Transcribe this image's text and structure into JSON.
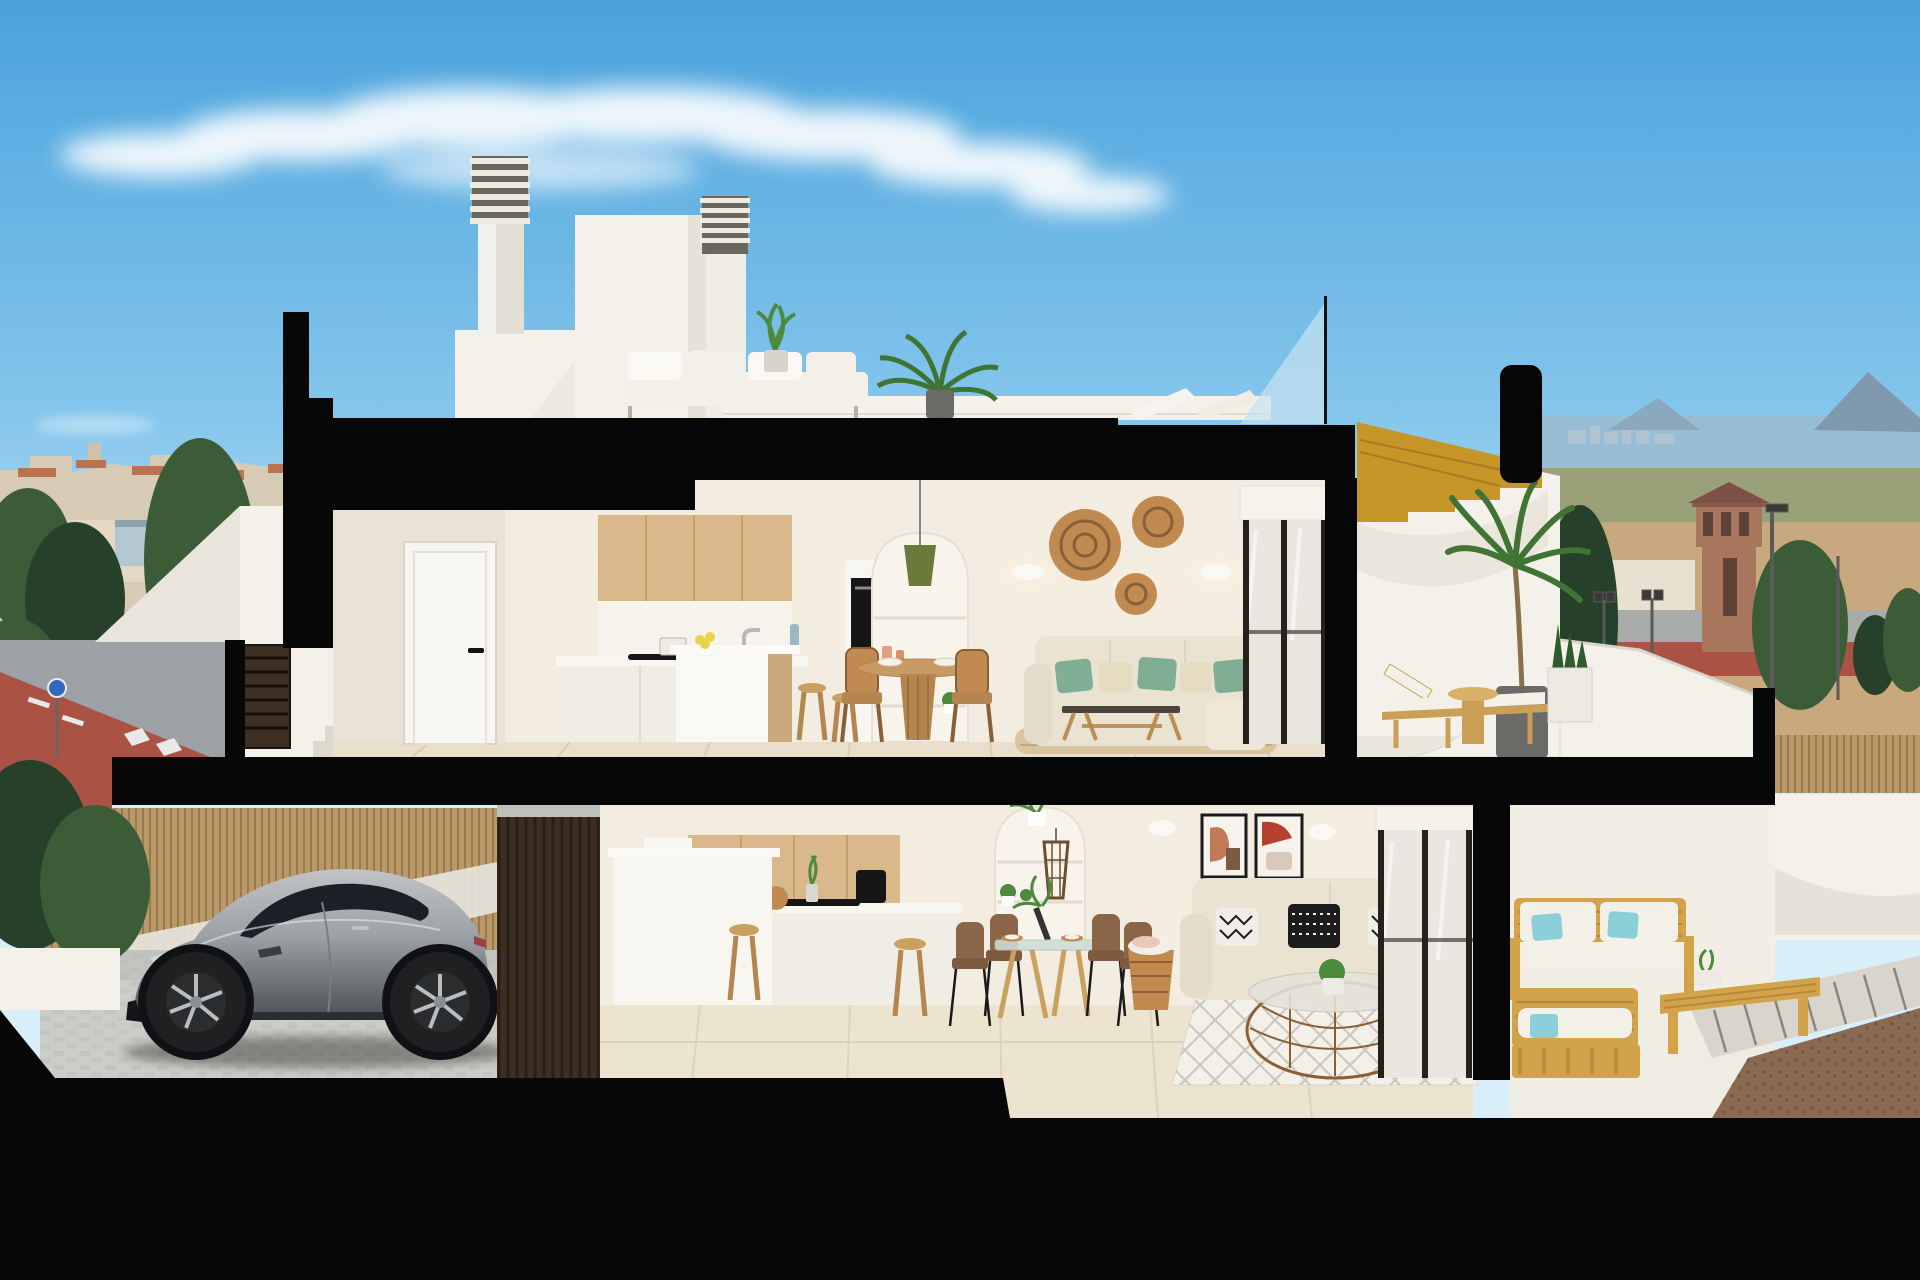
{
  "scene": {
    "kind": "architectural cross-section render",
    "subject": "two-storey coastal duplex cut-away with rooftop terrace, garage and furnished interiors",
    "elements": [
      "sky",
      "cloud-streak",
      "town-skyline-left",
      "sea-horizon-right",
      "watchtower",
      "cypress-trees",
      "street-with-bike-lane",
      "entrance-stairs",
      "louvered-gate",
      "section-cut-frame",
      "rooftop-terrace",
      "chimney",
      "stair-bulkhead",
      "rooftop-sofa",
      "rooftop-palm",
      "lounge-chairs",
      "upper-kitchen",
      "upper-hall-door",
      "kitchen-island",
      "dining-set",
      "arched-niche",
      "living-sofa",
      "coffee-table",
      "wicker-wall-discs",
      "wall-sconces",
      "sliding-glass-door",
      "wood-staircase",
      "upper-terrace-lounger",
      "terrace-palm",
      "garage",
      "sports-car",
      "bamboo-fence",
      "slat-feature-wall",
      "lower-kitchen",
      "lower-dining-set",
      "lower-sofa",
      "rattan-coffee-table",
      "diamond-rug",
      "framed-artworks",
      "lower-terrace-wood-sofas",
      "outdoor-bench-table",
      "walkway",
      "gravel-bed"
    ]
  },
  "palette": {
    "sky_top": "#4AA2DC",
    "sky_mid": "#85C6EC",
    "sky_horizon": "#D8EEF8",
    "cloud": "#FFFFFF",
    "sea": "#97BED4",
    "skyline": "#AFC4D2",
    "mountain": "#8199AE",
    "town_wall": "#D7CBB6",
    "town_roof": "#BA7350",
    "town_blue": "#B3C7D1",
    "tree_dark": "#26402A",
    "tree_mid": "#3C5C38",
    "scrub": "#9AA077",
    "field": "#C8A97F",
    "field_dry": "#C9A87E",
    "road_grey": "#9BA1A5",
    "road_red": "#AA5243",
    "lane_white": "#E8EAEA",
    "sign_blue": "#3468C0",
    "tower_brick": "#A8765C",
    "tower_roof": "#7E5146",
    "tower_dark": "#5E4236",
    "cut_black": "#070707",
    "wall_white": "#F4F1EA",
    "wall_shade": "#E3DFD5",
    "wall_warm": "#F2ECE1",
    "wall_dim": "#E9E2D5",
    "floor_tile": "#E9DFCB",
    "floor_tile_dark": "#D8CCB4",
    "floor_lower": "#EDE4D0",
    "wood_light": "#D9B98C",
    "wood_line": "#C4A26C",
    "wood_stair": "#C79628",
    "wood_table": "#C89B66",
    "counter": "#F8F6F1",
    "appliance_black": "#161616",
    "sofa_cream": "#EBE3D2",
    "pillow_green": "#7FAE94",
    "pillow_cream": "#E6DCC2",
    "pillow_black": "#1C1C1C",
    "rattan": "#C08A50",
    "rattan_dark": "#8A5F36",
    "rug_jute": "#D8C29C",
    "rug_white": "#F3F0E9",
    "glass_pane": "#C8E2F0",
    "frame_dark": "#26211B",
    "glass_door": "#E9E7E0",
    "bamboo": "#B89967",
    "slat_brown": "#3C2E22",
    "concrete": "#BFBFBC",
    "cobble": "#CCCCC8",
    "car_silver": "#C2C5C8",
    "car_dark": "#4A4E52",
    "car_glass": "#1C2026",
    "tire": "#1E2022",
    "rim": "#B9BDBF",
    "lounger_wood": "#C9A055",
    "outdoor_wood": "#D3A34B",
    "cushion_white": "#F3F0E7",
    "pillow_teal": "#8BCFD9",
    "gravel": "#8A6A52",
    "plant": "#4E8A3E",
    "plant_dark": "#2F5C2C",
    "pot_grey": "#6A6A66",
    "planter_white": "#ECEAE2",
    "lemon": "#E8D44A",
    "glow": "#FFF3DC",
    "art_rust": "#C07A55",
    "art_brown": "#7E5A42"
  }
}
